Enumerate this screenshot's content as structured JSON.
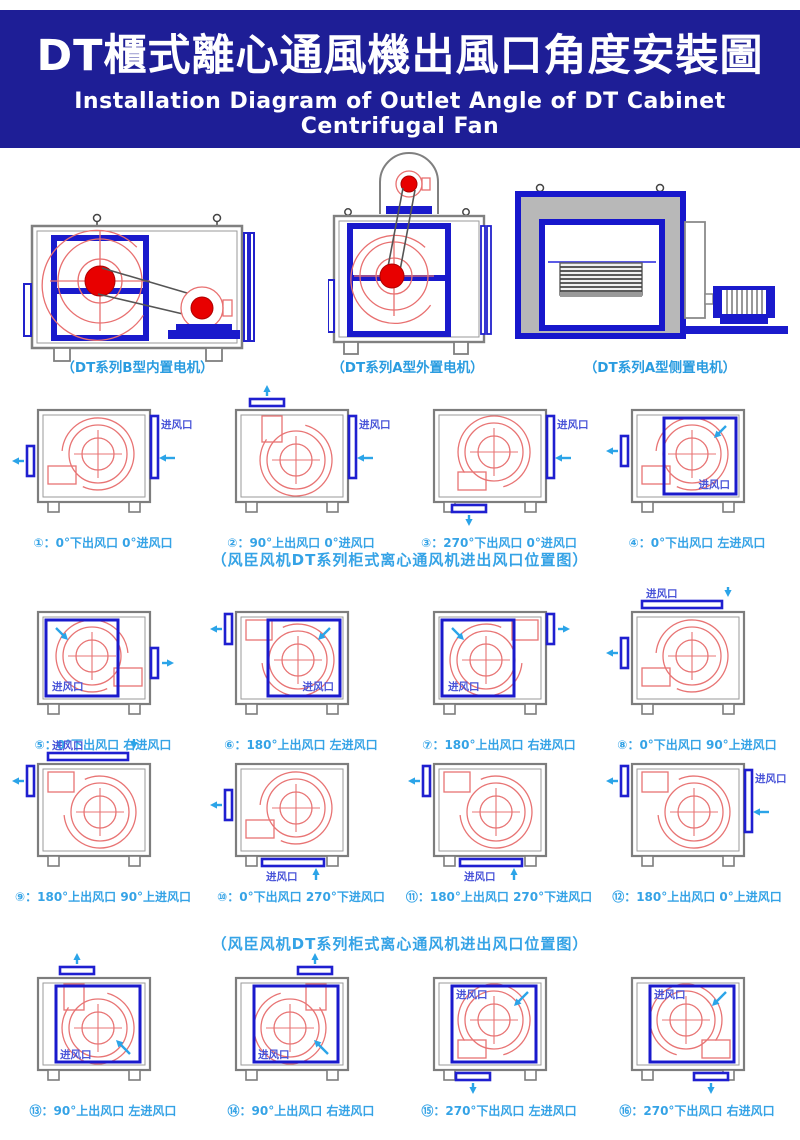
{
  "header": {
    "title": "DT櫃式離心通風機出風口角度安裝圖",
    "subtitle": "Installation Diagram of Outlet Angle of DT Cabinet Centrifugal Fan"
  },
  "top_drawings": [
    {
      "caption": "（DT系列B型内置电机）"
    },
    {
      "caption": "（DT系列A型外置电机）"
    },
    {
      "caption": "（DT系列A型侧置电机）"
    }
  ],
  "section_captions": {
    "first": "（风臣风机DT系列柜式离心通风机进出风口位置图）",
    "second": "（风臣风机DT系列柜式离心通风机进出风口位置图）"
  },
  "inlet_label": "进风口",
  "colors": {
    "header_bg": "#1e1e96",
    "caption_blue": "#2a9ce0",
    "section_blue": "#35a3e6",
    "label_blue": "#4a55d8",
    "bar_blue": "#1f1fd0",
    "frame_blue": "#1a1acc",
    "arrow_cyan": "#2ba4e8",
    "fan_red": "#e87474",
    "hub_red": "#e80000",
    "cabinet_gray": "#7d7d7d",
    "panel_gray": "#b8b8b8"
  },
  "diagrams": [
    {
      "caption": "①：0°下出风口 0°进风口",
      "volute": "lb",
      "inlet": "right-bar",
      "outlet": "left-bottom"
    },
    {
      "caption": "②：90°上出风口 0°进风口",
      "volute": "tl",
      "inlet": "right-bar",
      "outlet": "top-left"
    },
    {
      "caption": "③：270°下出风口 0°进风口",
      "volute": "bl",
      "inlet": "right-bar",
      "outlet": "bottom-left"
    },
    {
      "caption": "④：0°下出风口 左进风口",
      "volute": "lb",
      "inlet": "square-right",
      "outlet": "left-mid"
    },
    {
      "caption": "⑤：0°下出风口 右进风口",
      "volute": "rb",
      "inlet": "square-left",
      "outlet": "right-bottom"
    },
    {
      "caption": "⑥：180°上出风口 左进风口",
      "volute": "lt",
      "inlet": "square-right",
      "outlet": "left-top"
    },
    {
      "caption": "⑦：180°上出风口 右进风口",
      "volute": "rt",
      "inlet": "square-left",
      "outlet": "right-top"
    },
    {
      "caption": "⑧：0°下出风口 90°上进风口",
      "volute": "lb",
      "inlet": "top-bar",
      "outlet": "left-mid"
    },
    {
      "caption": "⑨：180°上出风口 90°上进风口",
      "volute": "lt",
      "inlet": "top-bar",
      "outlet": "left-top"
    },
    {
      "caption": "⑩：0°下出风口 270°下进风口",
      "volute": "lb",
      "inlet": "bottom-bar",
      "outlet": "left-mid"
    },
    {
      "caption": "⑪：180°上出风口 270°下进风口",
      "volute": "lt",
      "inlet": "bottom-bar",
      "outlet": "left-top"
    },
    {
      "caption": "⑫：180°上出风口 0°上进风口",
      "volute": "lt",
      "inlet": "right-bar",
      "outlet": "left-top"
    },
    {
      "caption": "⑬：90°上出风口 左进风口",
      "volute": "tl",
      "inlet": "square-center-bl",
      "outlet": "top-midleft"
    },
    {
      "caption": "⑭：90°上出风口 右进风口",
      "volute": "tr",
      "inlet": "square-center-bl",
      "outlet": "top-midright"
    },
    {
      "caption": "⑮：270°下出风口 左进风口",
      "volute": "bl",
      "inlet": "square-center-tl",
      "outlet": "bottom-midleft"
    },
    {
      "caption": "⑯：270°下出风口 右进风口",
      "volute": "br",
      "inlet": "square-center-tl",
      "outlet": "bottom-midright"
    }
  ]
}
